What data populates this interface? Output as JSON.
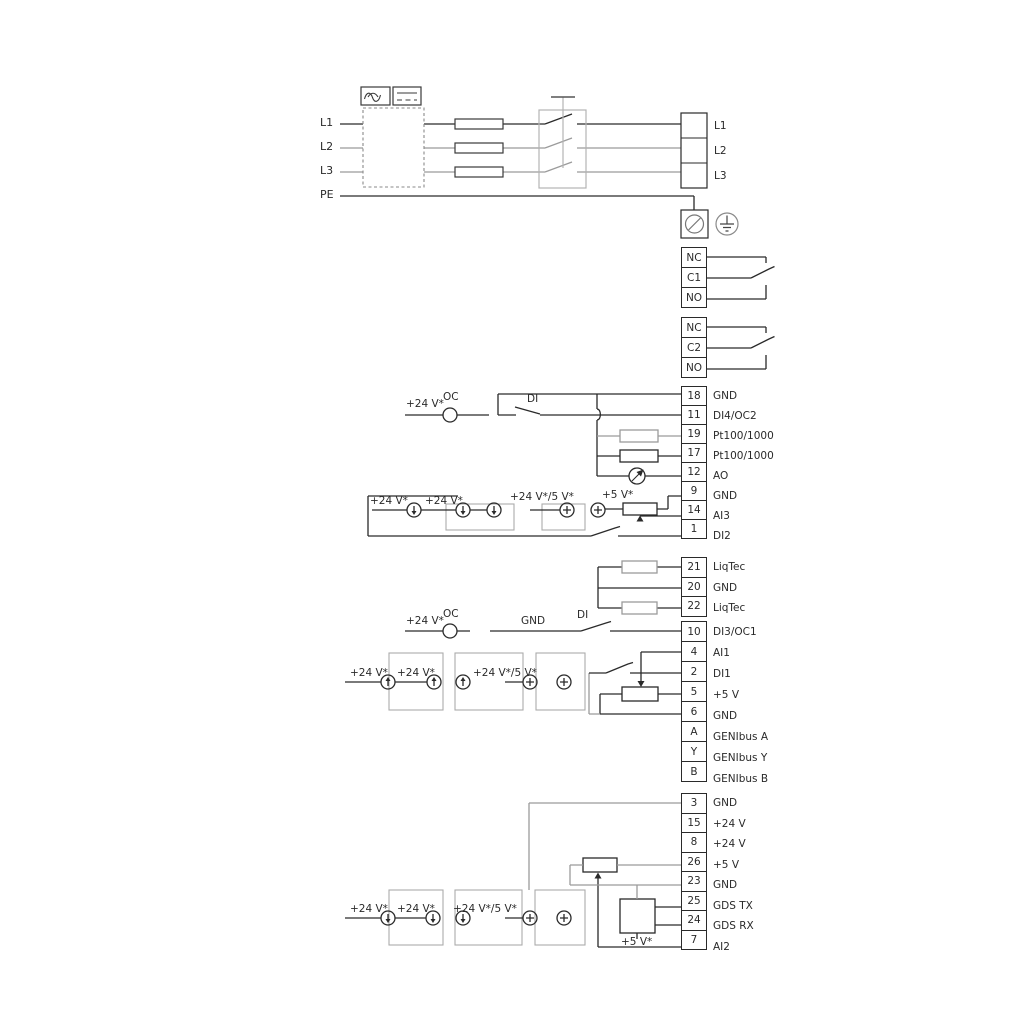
{
  "power": {
    "left_labels": [
      "L1",
      "L2",
      "L3",
      "PE"
    ],
    "right_labels": [
      "L1",
      "L2",
      "L3"
    ]
  },
  "relays": {
    "relay1": [
      "NC",
      "C1",
      "NO"
    ],
    "relay2": [
      "NC",
      "C2",
      "NO"
    ]
  },
  "io1": [
    {
      "num": "18",
      "label": "GND"
    },
    {
      "num": "11",
      "label": "DI4/OC2"
    },
    {
      "num": "19",
      "label": "Pt100/1000"
    },
    {
      "num": "17",
      "label": "Pt100/1000"
    },
    {
      "num": "12",
      "label": "AO"
    },
    {
      "num": "9",
      "label": "GND"
    },
    {
      "num": "14",
      "label": "AI3"
    },
    {
      "num": "1",
      "label": "DI2"
    }
  ],
  "liqtec": [
    {
      "num": "21",
      "label": "LiqTec"
    },
    {
      "num": "20",
      "label": "GND"
    },
    {
      "num": "22",
      "label": "LiqTec"
    }
  ],
  "io2": [
    {
      "num": "10",
      "label": "DI3/OC1"
    },
    {
      "num": "4",
      "label": "AI1"
    },
    {
      "num": "2",
      "label": "DI1"
    },
    {
      "num": "5",
      "label": "+5 V"
    },
    {
      "num": "6",
      "label": "GND"
    },
    {
      "num": "A",
      "label": "GENIbus A"
    },
    {
      "num": "Y",
      "label": "GENIbus Y"
    },
    {
      "num": "B",
      "label": "GENIbus B"
    }
  ],
  "io3": [
    {
      "num": "3",
      "label": "GND"
    },
    {
      "num": "15",
      "label": "+24 V"
    },
    {
      "num": "8",
      "label": "+24 V"
    },
    {
      "num": "26",
      "label": "+5 V"
    },
    {
      "num": "23",
      "label": "GND"
    },
    {
      "num": "25",
      "label": "GDS TX"
    },
    {
      "num": "24",
      "label": "GDS RX"
    },
    {
      "num": "7",
      "label": "AI2"
    }
  ],
  "ann": {
    "plus24": "+24 V*",
    "plus24or5": "+24 V*/5 V*",
    "plus5": "+5 V*",
    "oc": "OC",
    "di": "DI",
    "gnd": "GND"
  },
  "colors": {
    "wire": "#2a2a2a",
    "wire_gray": "#9b9b9b"
  }
}
